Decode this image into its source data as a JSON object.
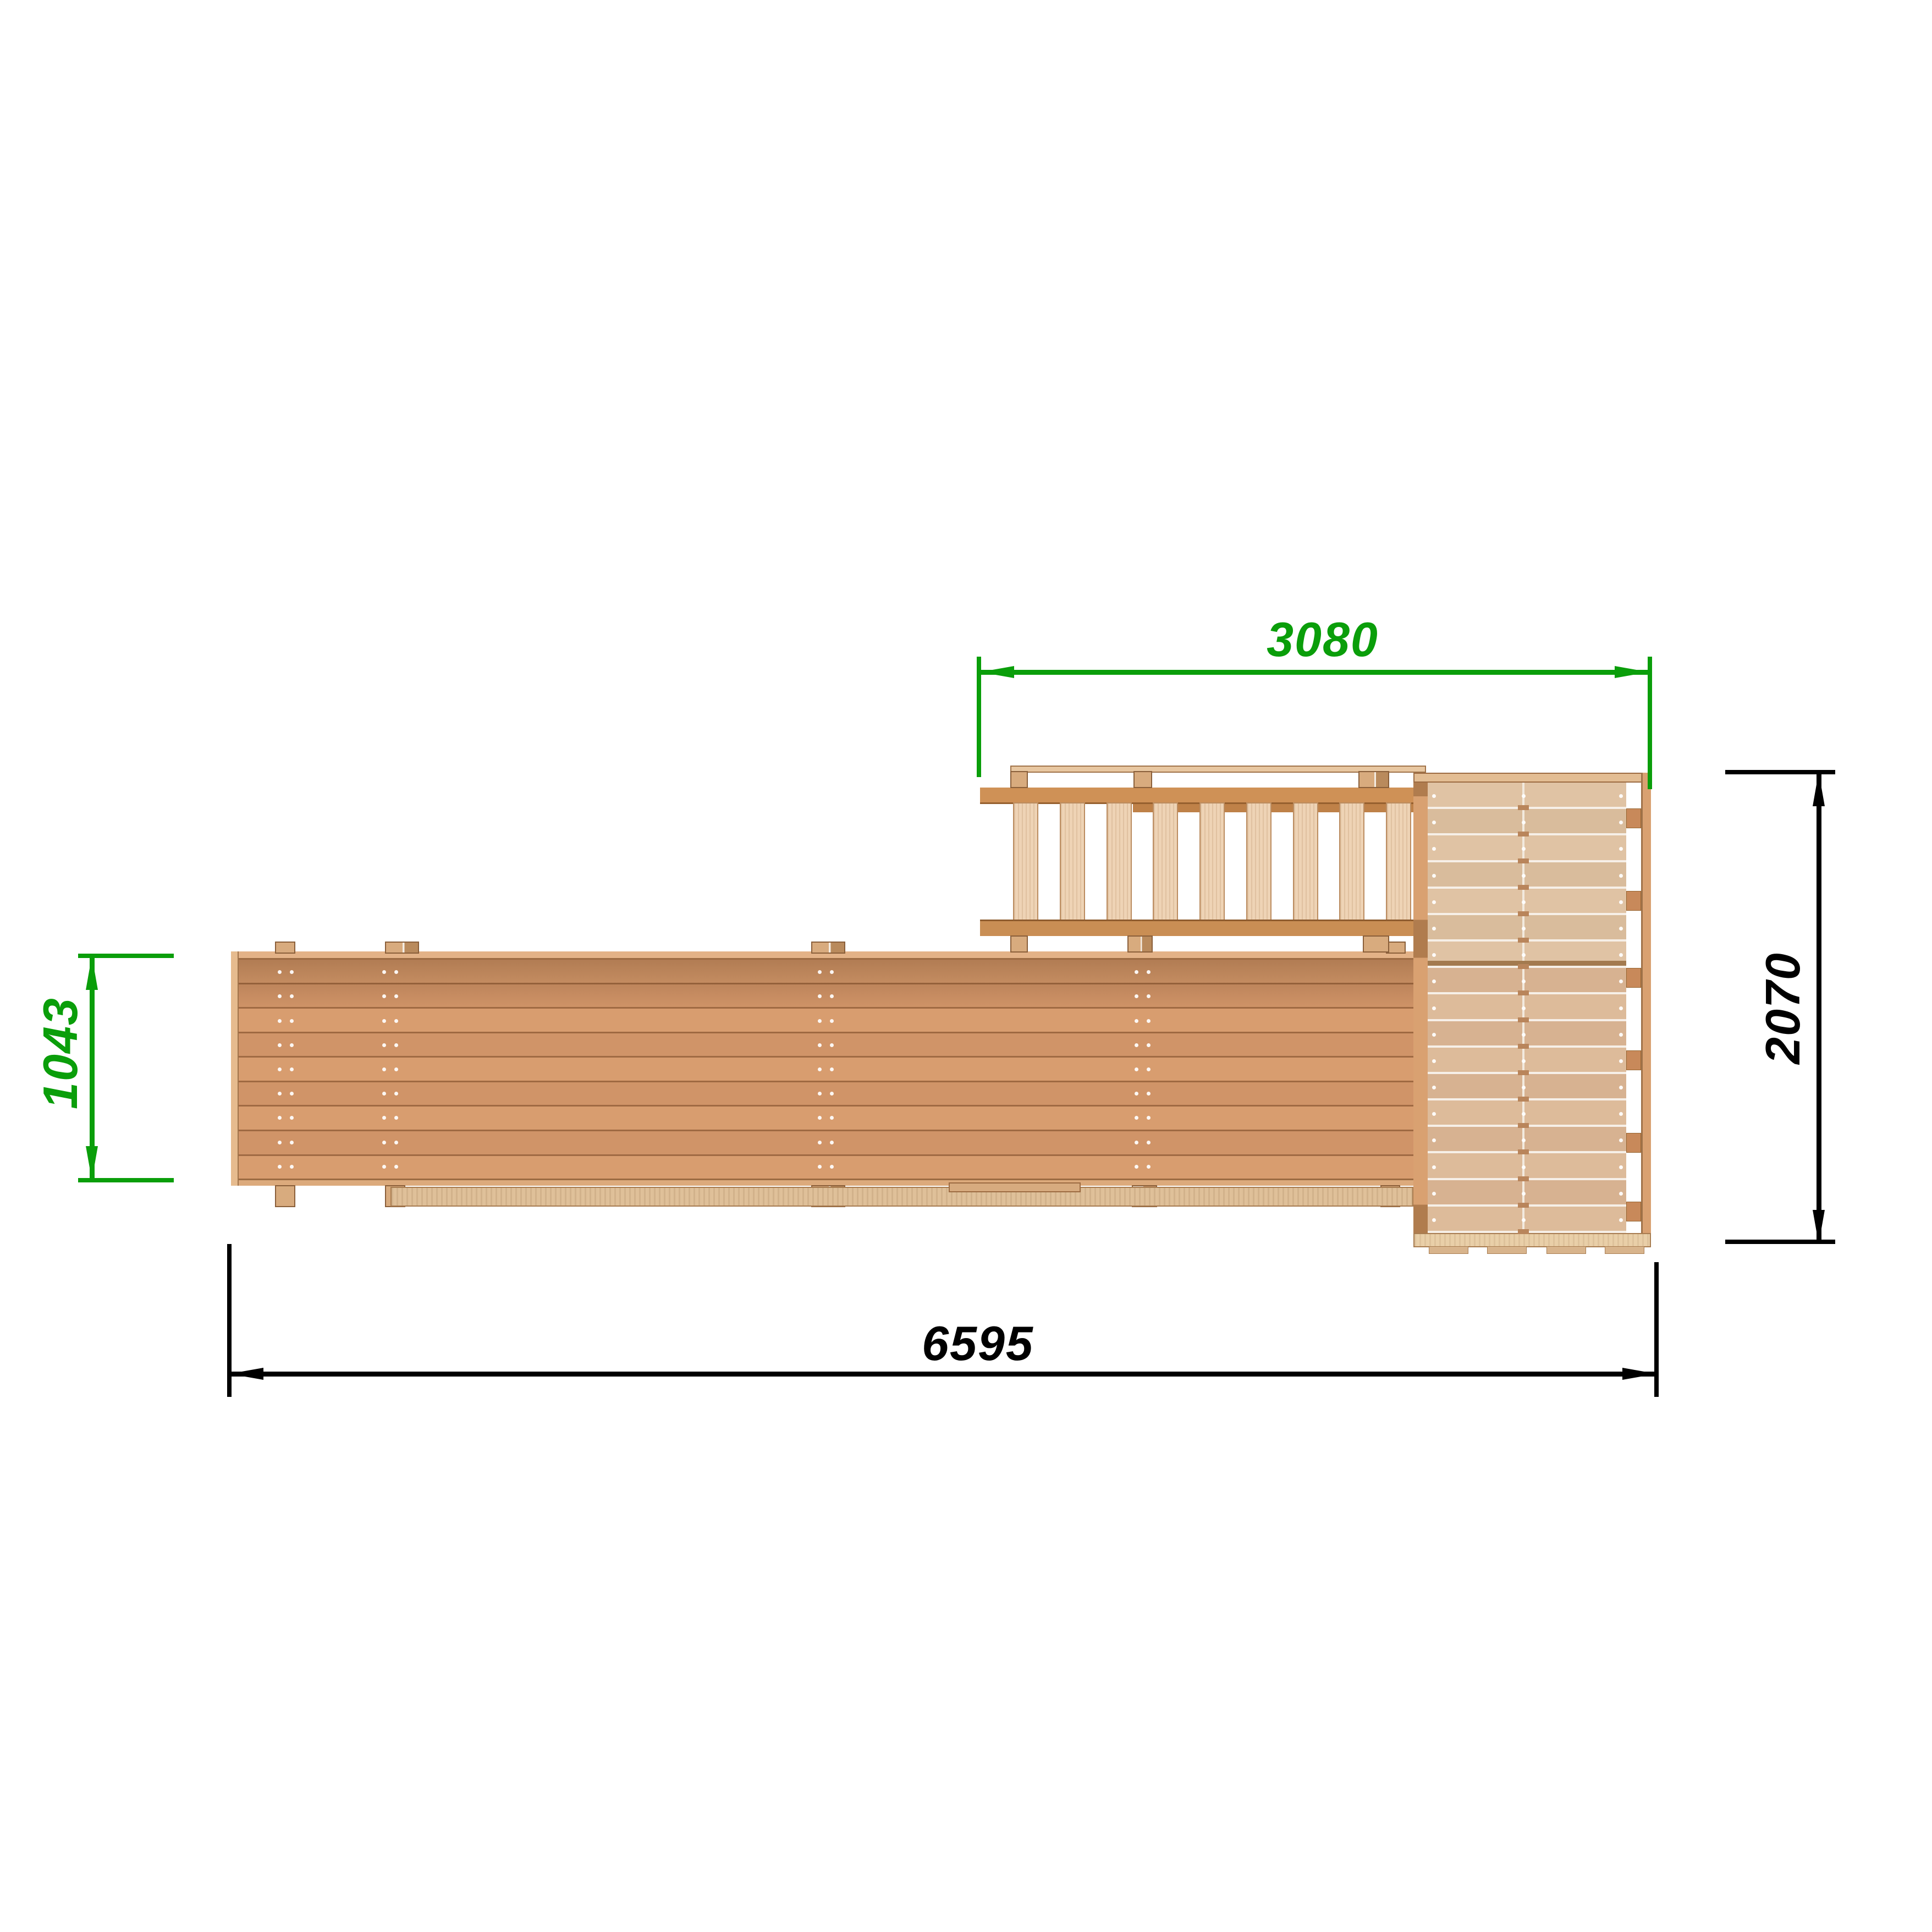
{
  "drawing": {
    "kind": "top-view dimensioned technical drawing of wooden play structure",
    "background_color": "#ffffff"
  },
  "dimensions": {
    "top": {
      "value": "3080",
      "color": "#0a9e0a",
      "orientation": "horizontal"
    },
    "right": {
      "value": "2070",
      "color": "#000000",
      "orientation": "vertical-rotated"
    },
    "left": {
      "value": "1043",
      "color": "#0a9e0a",
      "orientation": "vertical-rotated"
    },
    "bottom": {
      "value": "6595",
      "color": "#000000",
      "orientation": "horizontal"
    }
  },
  "structure": {
    "deck": {
      "plank_count": 9,
      "screw_dot_rows": 9
    },
    "ladder": {
      "rung_count": 9
    },
    "platform": {
      "board_row_count": 17,
      "screw_dot_columns": 3
    },
    "wood_colors": {
      "plank": "#d89d6f",
      "plank_alt": "#d09468",
      "edge_board": "#e3b287",
      "rail": "#cf9156",
      "rail_dark": "#bf8148",
      "rung": "#eed3b5",
      "platform_board_upper": "#d9bc9c",
      "platform_board_lower": "#d7b291",
      "frame": "#d9a171",
      "plywood_rail": "#dfc099",
      "post": "#d8ab7e"
    }
  }
}
